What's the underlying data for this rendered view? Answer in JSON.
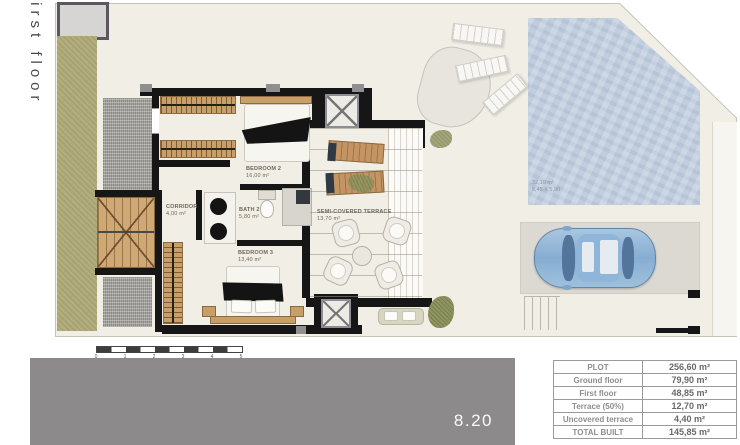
{
  "plan": {
    "floor_label": "First floor",
    "rooms": {
      "bedroom2": {
        "name": "BEDROOM 2",
        "area": "16,00 m²"
      },
      "corridor": {
        "name": "CORRIDOR",
        "area": "4,00 m²"
      },
      "bath2": {
        "name": "BATH 2",
        "area": "5,80 m²"
      },
      "bedroom3": {
        "name": "BEDROOM 3",
        "area": "13,40 m²"
      },
      "terrace": {
        "name": "SEMI-COVERED TERRACE",
        "area": "13,70 m²"
      }
    },
    "pool": {
      "area": "32,10 m²",
      "dimensions": "5,45 X 5,90"
    },
    "scale_ticks": [
      "0",
      "1",
      "2",
      "3",
      "4",
      "5"
    ]
  },
  "footer": {
    "plan_number": "8.20"
  },
  "areas_table": {
    "rows": [
      {
        "label": "PLOT",
        "value": "256,60 m²"
      },
      {
        "label": "Ground floor",
        "value": "79,90 m²"
      },
      {
        "label": "First floor",
        "value": "48,85 m²"
      },
      {
        "label": "Terrace (50%)",
        "value": "12,70 m²"
      },
      {
        "label": "Uncovered terrace",
        "value": "4,40 m²"
      },
      {
        "label": "TOTAL BUILT",
        "value": "145,85 m²"
      }
    ]
  },
  "colors": {
    "wall": "#161616",
    "wood": "#c99f68",
    "pool_water": "#c1cedf",
    "garden": "#b2ae7d",
    "gravel": "#a6a49f",
    "footer_bar": "#8c8a8a",
    "car": "#86aed2",
    "plan_floor": "#f1eee6"
  }
}
